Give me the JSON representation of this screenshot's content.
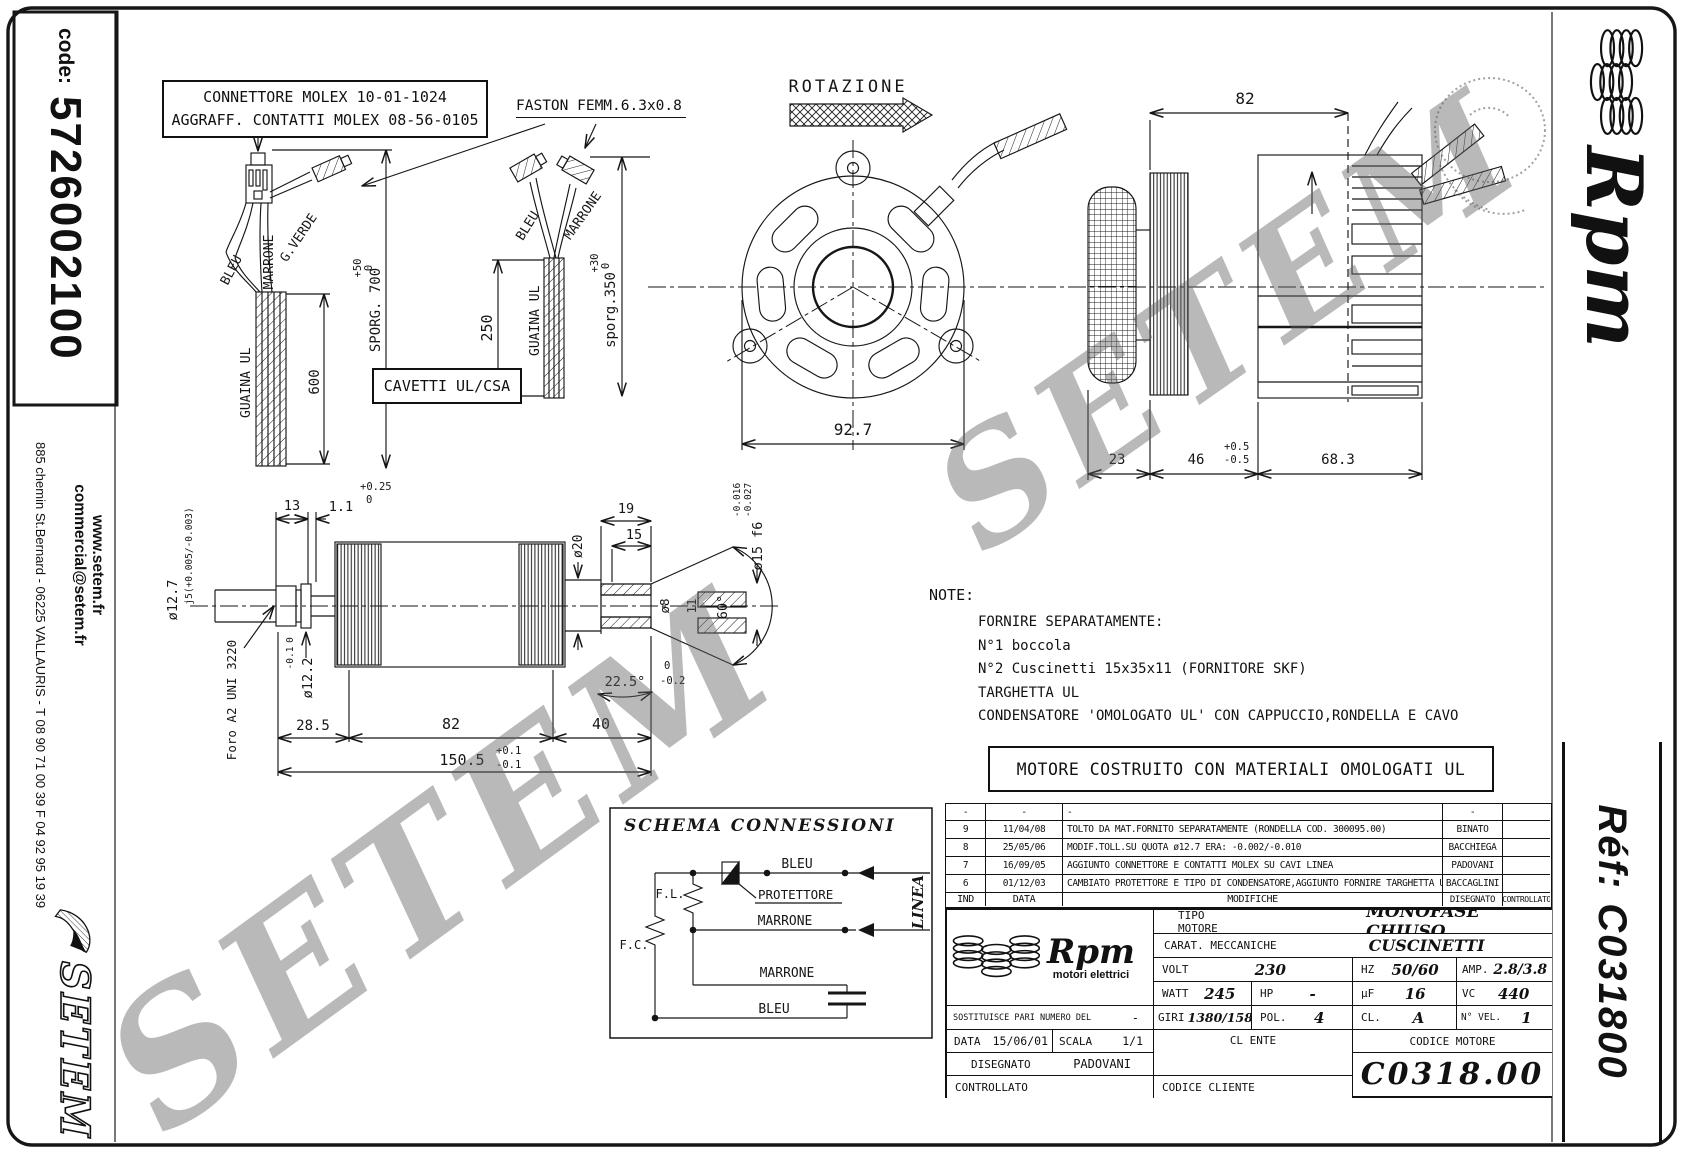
{
  "code": {
    "label": "code:",
    "value": "5726002100"
  },
  "sidebar_left": {
    "website": "www.setem.fr",
    "email": "commercial@setem.fr",
    "address": "885 chemin St.Bernard  -  06225 VALLAURIS  -  T 08 90 71 00 39   F 04 92 95 19 39",
    "logo_text": "SETEM"
  },
  "sidebar_right": {
    "brand_script": "Rpm",
    "ref_text": "Réf:  C031800"
  },
  "watermark": {
    "text": "SETEM"
  },
  "notes_box": {
    "line1": "CONNETTORE MOLEX 10-01-1024",
    "line2": "AGGRAFF. CONTATTI MOLEX 08-56-0105"
  },
  "labels": {
    "faston": "FASTON FEMM.6.3x0.8",
    "rotazione": "ROTAZIONE",
    "cavetti": "CAVETTI UL/CSA",
    "motore_box": "MOTORE COSTRUITO CON MATERIALI OMOLOGATI UL"
  },
  "wire1": {
    "bleu": "BLEU",
    "marrone": "MARRONE",
    "gverde": "G.VERDE",
    "guaina": "GUAINA UL",
    "dim600": "600",
    "sporg": "SPORG. 700",
    "tol_hi": "+50",
    "tol_lo": "0"
  },
  "wire2": {
    "bleu": "BLEU",
    "marrone": "MARRONE",
    "guaina": "GUAINA UL",
    "dim250": "250",
    "sporg": "sporg.350",
    "tol_hi": "+30",
    "tol_lo": "0"
  },
  "front_view": {
    "dim_width": "92.7"
  },
  "side_view": {
    "dim_top": "82",
    "dim_23": "23",
    "dim_46": "46",
    "tol46_hi": "+0.5",
    "tol46_lo": "-0.5",
    "dim_683": "68.3"
  },
  "shaft": {
    "dim13": "13",
    "dim11": "1.1",
    "tol11_hi": "+0.25",
    "tol11_lo": "0",
    "d127": "ø12.7",
    "d127_fit": "j5(+0.005/-0.003)",
    "d122": "ø12.2",
    "tol122_hi": "0",
    "tol122_lo": "-0.1",
    "foro": "Foro A2 UNI 3220",
    "dim285": "28.5",
    "dim82": "82",
    "dim40": "40",
    "dim1505": "150.5",
    "tol1505_hi": "+0.1",
    "tol1505_lo": "-0.1",
    "dim19": "19",
    "dim15": "15",
    "d20": "ø20",
    "d8": "ø8",
    "dim11b": "11",
    "ang60": "60°",
    "ang225": "22.5°",
    "tol225_hi": "0",
    "tol225_lo": "-0.2",
    "d15f6": "ø15 f6",
    "d15_tol_hi": "-0.016",
    "d15_tol_lo": "-0.027"
  },
  "note": {
    "title": "NOTE:",
    "lines": [
      "FORNIRE SEPARATAMENTE:",
      "N°1 boccola",
      "N°2 Cuscinetti 15x35x11 (FORNITORE SKF)",
      "TARGHETTA UL",
      "CONDENSATORE 'OMOLOGATO UL' CON CAPPUCCIO,RONDELLA E CAVO"
    ]
  },
  "schema": {
    "title": "SCHEMA CONNESSIONI",
    "fl": "F.L.",
    "fc": "F.C.",
    "protettore": "PROTETTORE",
    "bleu_top": "BLEU",
    "marrone_mid": "MARRONE",
    "marrone_bot": "MARRONE",
    "bleu_bot": "BLEU",
    "linea": "LINEA"
  },
  "revisions": {
    "col_ind": "IND",
    "col_data": "DATA",
    "col_mod": "MODIFICHE",
    "col_dis": "DISEGNATO",
    "col_con": "CONTROLLATO",
    "rows": [
      {
        "ind": "-",
        "date": "-",
        "text": "-",
        "name": "-"
      },
      {
        "ind": "9",
        "date": "11/04/08",
        "text": "TOLTO DA MAT.FORNITO SEPARATAMENTE (RONDELLA COD. 300095.00)",
        "name": "BINATO"
      },
      {
        "ind": "8",
        "date": "25/05/06",
        "text": "MODIF.TOLL.SU QUOTA ø12.7 ERA: -0.002/-0.010",
        "name": "BACCHIEGA"
      },
      {
        "ind": "7",
        "date": "16/09/05",
        "text": "AGGIUNTO CONNETTORE E CONTATTI MOLEX SU CAVI LINEA",
        "name": "PADOVANI"
      },
      {
        "ind": "6",
        "date": "01/12/03",
        "text": "CAMBIATO PROTETTORE E TIPO DI CONDENSATORE,AGGIUNTO FORNIRE TARGHETTA UL",
        "name": "BACCAGLINI"
      }
    ]
  },
  "titleblock": {
    "brand_script": "Rpm",
    "brand_sub": "motori elettrici",
    "tipo_label": "TIPO MOTORE",
    "tipo_value": "MONOFASE CHIUSO",
    "carat_label": "CARAT. MECCANICHE",
    "carat_value": "CUSCINETTI",
    "volt_label": "VOLT",
    "volt_value": "230",
    "hz_label": "HZ",
    "hz_value": "50/60",
    "amp_label": "AMP.",
    "amp_value": "2.8/3.8",
    "watt_label": "WATT",
    "watt_value": "245",
    "hp_label": "HP",
    "hp_value": "-",
    "uf_label": "µF",
    "uf_value": "16",
    "vc_label": "VC",
    "vc_value": "440",
    "sost_label": "SOSTITUISCE PARI NUMERO DEL",
    "sost_value": "-",
    "giri_label": "GIRI",
    "giri_value": "1380/1580",
    "pol_label": "POL.",
    "pol_value": "4",
    "cl_label": "CL.",
    "cl_value": "A",
    "nvel_label": "N° VEL.",
    "nvel_value": "1",
    "data_label": "DATA",
    "data_value": "15/06/01",
    "scala_label": "SCALA",
    "scala_value": "1/1",
    "clente_label": "CL ENTE",
    "codmot_label": "CODICE MOTORE",
    "codmot_value": "C0318.00",
    "dis_label": "DISEGNATO",
    "dis_value": "PADOVANI",
    "contr_label": "CONTROLLATO",
    "codcli_label": "CODICE CLIENTE"
  }
}
